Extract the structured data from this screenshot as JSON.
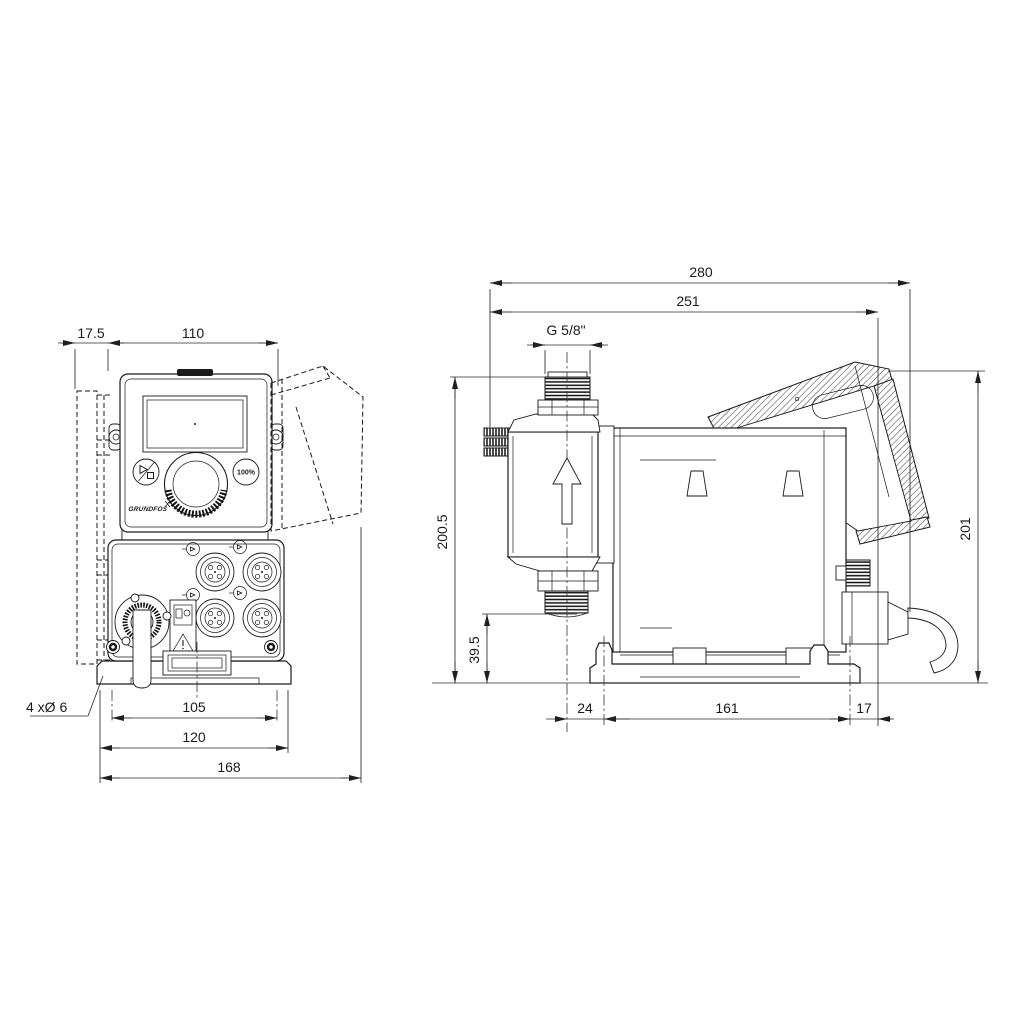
{
  "drawing": {
    "front_view": {
      "dim_wall_offset": "17.5",
      "dim_width": "110",
      "dim_hole_spacing": "105",
      "dim_base_width": "120",
      "dim_overall_width": "168",
      "label_mounting_holes": "4 xØ 6",
      "panel": {
        "button_100": "100%",
        "brand": "GRUNDFOS"
      }
    },
    "side_view": {
      "dim_overall_depth": "280",
      "dim_depth_less_cable": "251",
      "label_thread": "G 5/8\"",
      "dim_height_to_connector": "200.5",
      "dim_valve_clearance": "39.5",
      "dim_overall_height": "201",
      "dim_head_overhang": "24",
      "dim_base_depth": "161",
      "dim_rear_overhang": "17"
    }
  }
}
